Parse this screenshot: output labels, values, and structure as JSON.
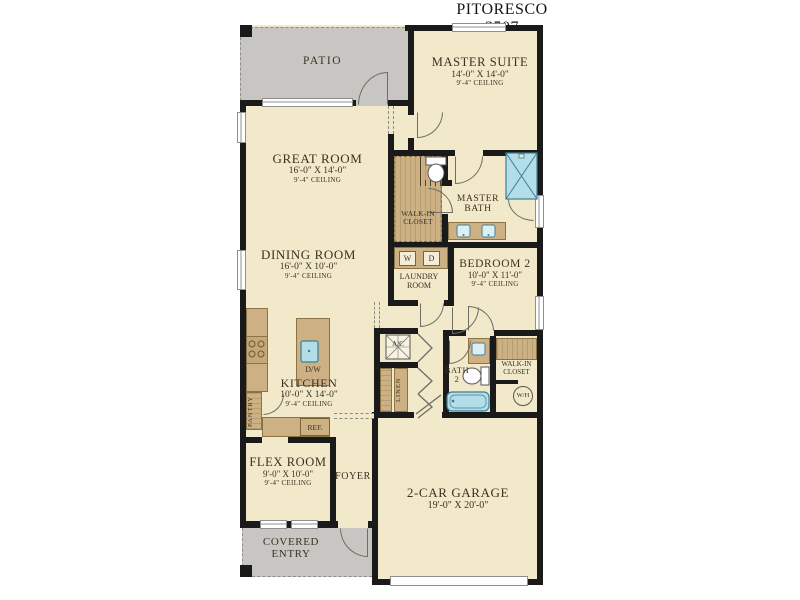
{
  "title": "PITORESCO 3507",
  "rooms": {
    "patio": {
      "name": "PATIO"
    },
    "master_suite": {
      "name": "MASTER SUITE",
      "dims": "14'-0\" X 14'-0\"",
      "ceiling": "9'-4\" CEILING"
    },
    "great_room": {
      "name": "GREAT ROOM",
      "dims": "16'-0\" X 14'-0\"",
      "ceiling": "9'-4\" CEILING"
    },
    "walk_in_closet_master": {
      "name": "WALK-IN CLOSET"
    },
    "master_bath": {
      "name": "MASTER BATH"
    },
    "dining_room": {
      "name": "DINING ROOM",
      "dims": "16'-0\" X 10'-0\"",
      "ceiling": "9'-4\" CEILING"
    },
    "laundry_room": {
      "name": "LAUNDRY ROOM"
    },
    "bedroom_2": {
      "name": "BEDROOM 2",
      "dims": "10'-0\" X 11'-0\"",
      "ceiling": "9'-4\" CEILING"
    },
    "kitchen": {
      "name": "KITCHEN",
      "dims": "10'-0\" X 14'-0\"",
      "ceiling": "9'-4\" CEILING"
    },
    "pantry": {
      "name": "PANTRY"
    },
    "linen": {
      "name": "LINEN"
    },
    "bath_2": {
      "name": "BATH 2"
    },
    "walk_in_closet_2": {
      "name": "WALK-IN CLOSET"
    },
    "flex_room": {
      "name": "FLEX ROOM",
      "dims": "9'-0\" X 10'-0\"",
      "ceiling": "9'-4\" CEILING"
    },
    "foyer": {
      "name": "FOYER"
    },
    "garage": {
      "name": "2-CAR GARAGE",
      "dims": "19'-0\" X 20'-0\""
    },
    "covered_entry": {
      "name": "COVERED ENTRY"
    }
  },
  "fixtures": {
    "washer": "W",
    "dryer": "D",
    "dishwasher": "D/W",
    "refrigerator": "REF.",
    "ac_unit": "A/C",
    "water_heater": "W/H"
  },
  "colors": {
    "floor": "#f2e8ca",
    "outdoor": "#c7c6c2",
    "wall": "#1a1a1a",
    "cabinet": "#cdb184",
    "fixture_blue": "#b3dde8"
  }
}
